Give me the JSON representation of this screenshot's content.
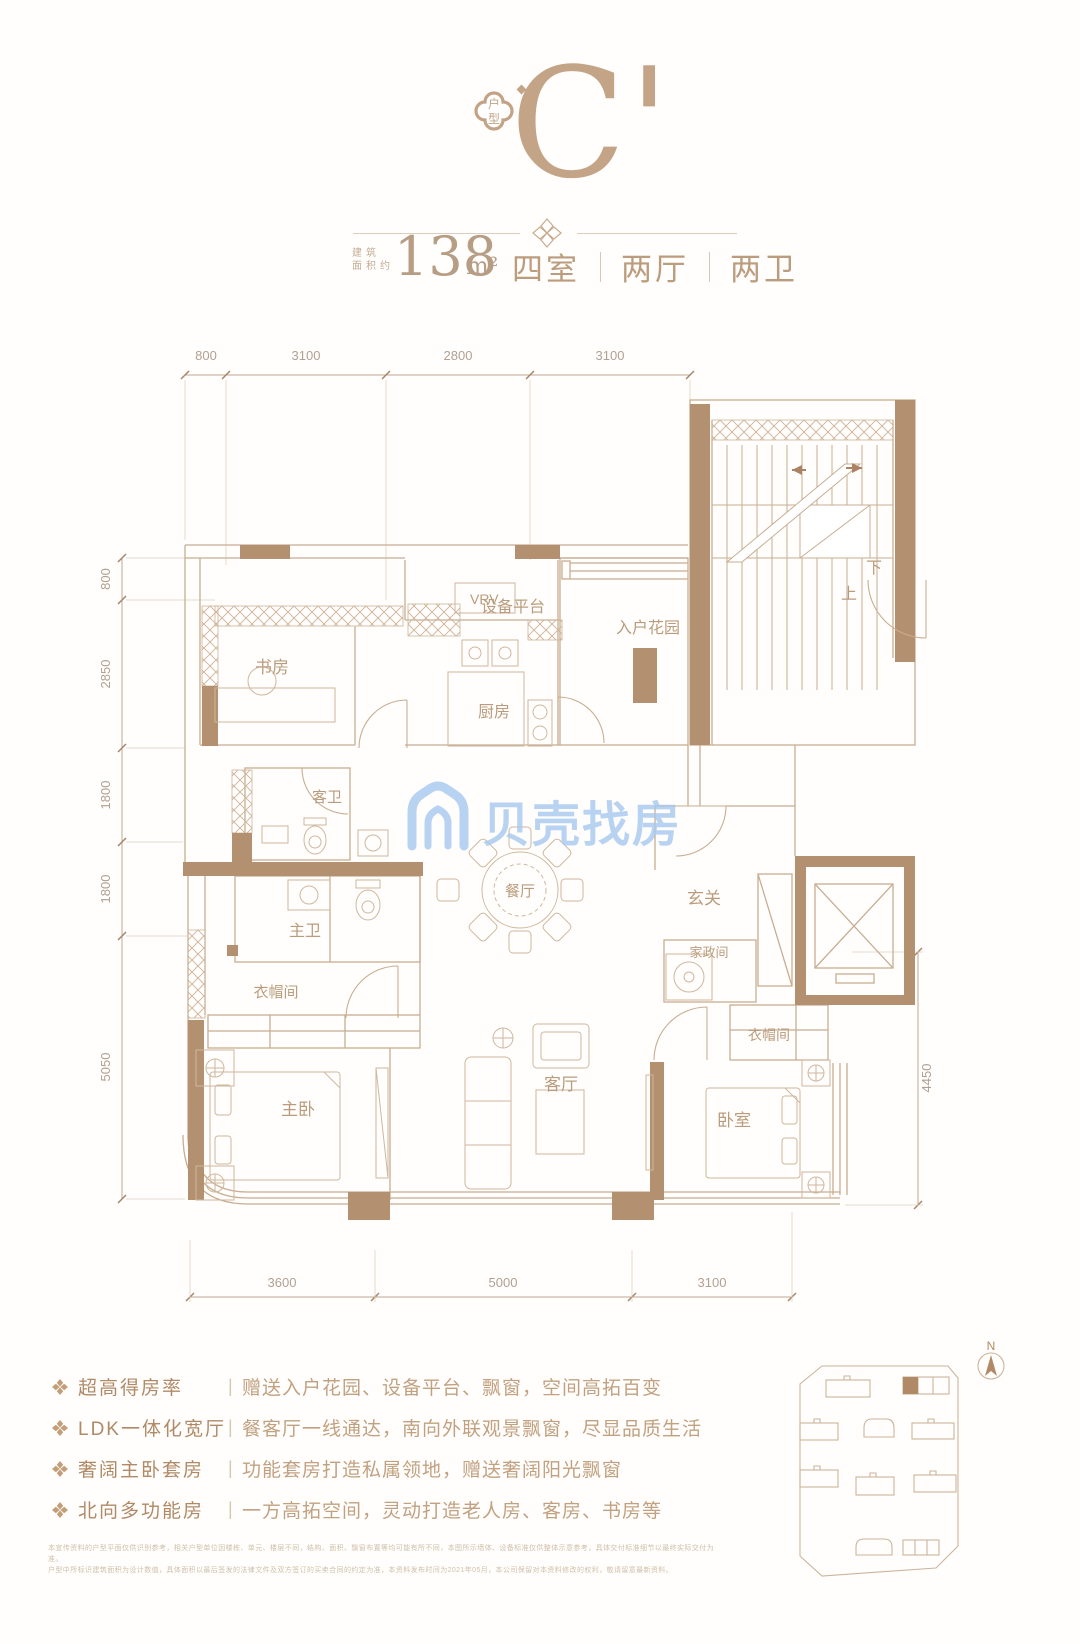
{
  "header": {
    "badge_char_top": "户",
    "badge_char_bottom": "型",
    "unit_letter": "C'",
    "area_prefix_line1": "建筑",
    "area_prefix_line2": "面积约",
    "area_value": "138",
    "area_unit": "m²",
    "spec": [
      "四室",
      "两厅",
      "两卫"
    ]
  },
  "floorplan": {
    "dims_top": [
      "800",
      "3100",
      "2800",
      "3100"
    ],
    "dims_left": [
      "800",
      "2850",
      "1800",
      "1800",
      "5050"
    ],
    "dims_bottom": [
      "3600",
      "5000",
      "3100"
    ],
    "dims_right": [
      "4450"
    ],
    "rooms": {
      "study": "书房",
      "vrv": "VRV",
      "equipment_platform": "设备平台",
      "kitchen": "厨房",
      "entry_garden": "入户花园",
      "stairs_up": "上",
      "stairs_down": "下",
      "guest_bath": "客卫",
      "master_bath": "主卫",
      "dining": "餐厅",
      "foyer": "玄关",
      "housekeeping": "家政间",
      "cloakroom_master": "衣帽间",
      "cloakroom_second": "衣帽间",
      "master_bedroom": "主卧",
      "living": "客厅",
      "bedroom": "卧室"
    },
    "watermark": "贝壳找房"
  },
  "features": [
    {
      "title": "超高得房率",
      "desc": "赠送入户花园、设备平台、飘窗，空间高拓百变"
    },
    {
      "title": "LDK一体化宽厅",
      "desc": "餐客厅一线通达，南向外联观景飘窗，尽显品质生活"
    },
    {
      "title": "奢阔主卧套房",
      "desc": "功能套房打造私属领地，赠送奢阔阳光飘窗"
    },
    {
      "title": "北向多功能房",
      "desc": "一方高拓空间，灵动打造老人房、客房、书房等"
    }
  ],
  "site_plan": {
    "north_label": "N"
  },
  "disclaimer": {
    "line1": "本宣传资料的户型平面仅供识别参考，相关户型单位因楼栋、单元、楼层不同，结构、面积、飘窗布置等均可能有所不同，本图所示墙体、设备标准仅供整体示意参考，具体交付标准细节以最终实际交付为准。",
    "line2": "户型中所标识建筑面积为设计数值，具体面积以最后签发的法律文件及双方签订的买卖合同的约定为准，本资料发布时间为2021年05月，本公司保留对本资料修改的权利，敬请留意最新资料。"
  }
}
